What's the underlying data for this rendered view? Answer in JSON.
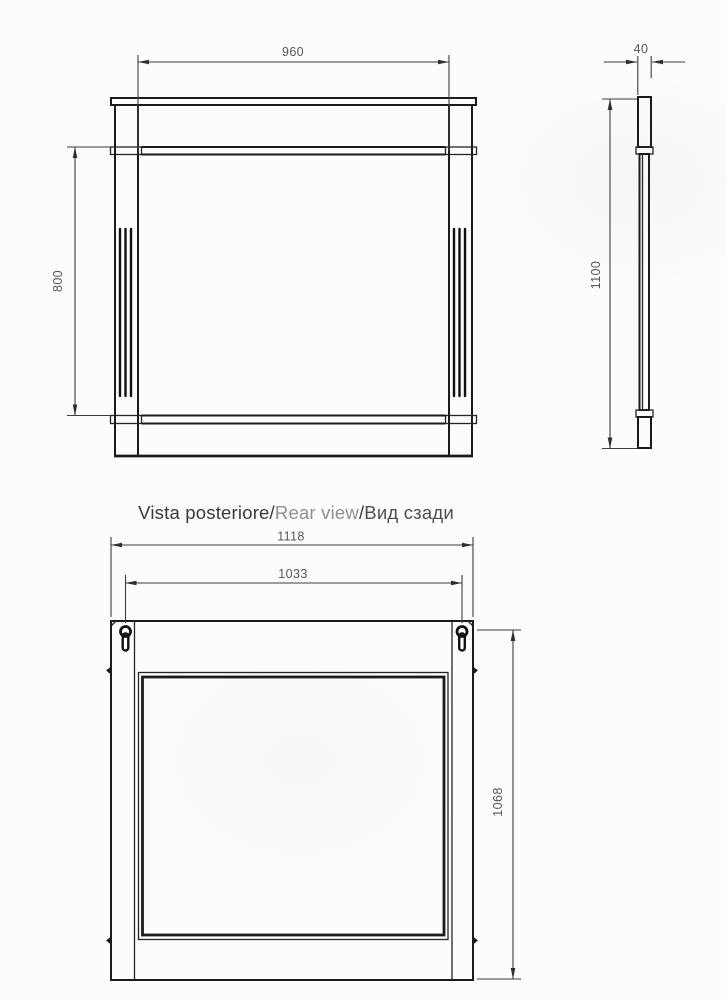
{
  "drawing": {
    "title": {
      "part_italian": "Vista posteriore",
      "separator": "/",
      "part_english": "Rear view",
      "part_russian": "Вид сзади"
    },
    "front_view": {
      "width": "960",
      "mirror_height": "800"
    },
    "side_view": {
      "depth": "40",
      "height": "1100"
    },
    "rear_view": {
      "overall_width": "1118",
      "hanger_spacing": "1033",
      "hanger_to_bottom_height": "1068"
    },
    "colors": {
      "object_line": "#1b1b1b",
      "dimension_line": "#3d3d3d",
      "dimension_text": "#565656",
      "title_primary": "#393939",
      "title_secondary": "#8f8f8f",
      "title_tertiary": "#4e4e4e",
      "background": "#fcfcfc"
    }
  }
}
